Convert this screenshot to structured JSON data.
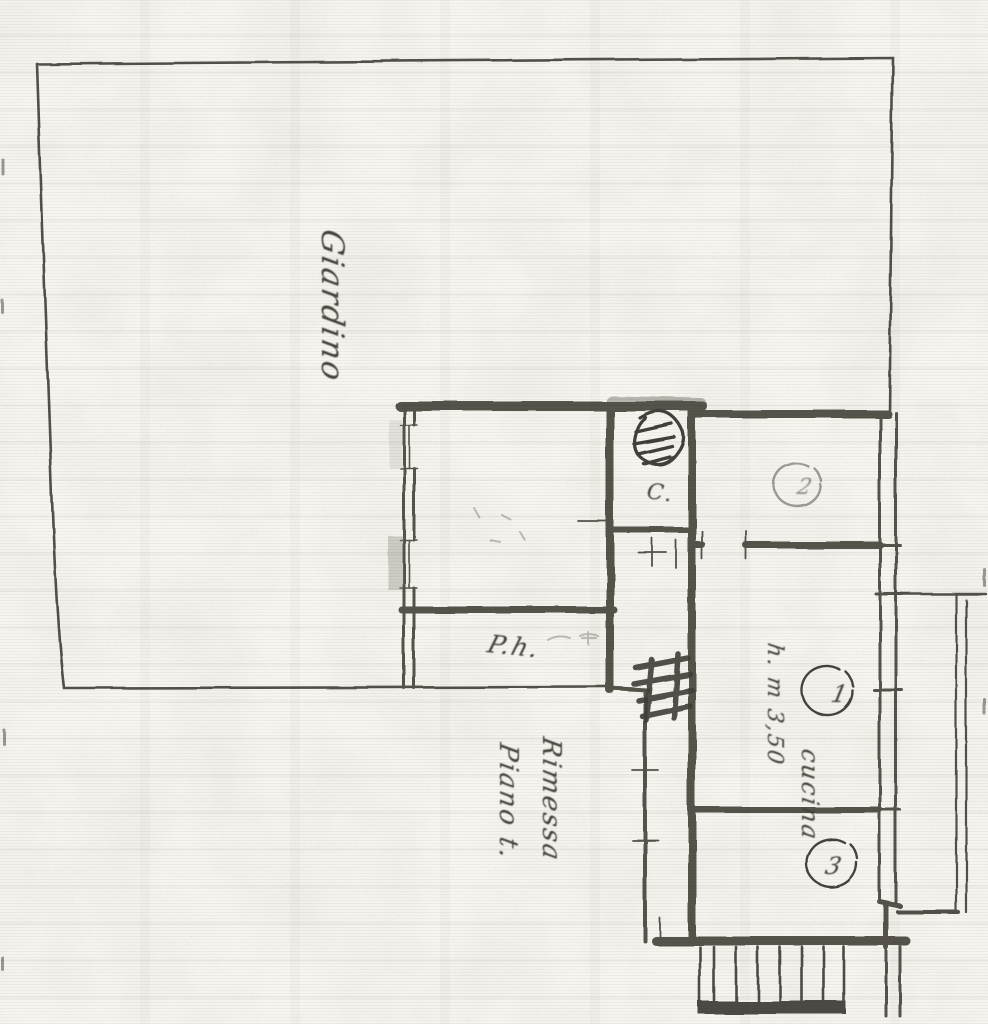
{
  "document": {
    "kind": "scanned hand-drawn floor plan",
    "paper_color": "#f7f5f0",
    "ink_color": "#4b4740"
  },
  "labels": {
    "garden": "Giardino",
    "annotation_line1": "Piano t.",
    "annotation_line2": "Rimessa",
    "height_note": "h. m 3,50",
    "kitchen": "cucina",
    "lower_room": "P.h.",
    "closet": "C."
  },
  "rooms": {
    "room1": "1",
    "room2": "2",
    "room3": "3"
  }
}
